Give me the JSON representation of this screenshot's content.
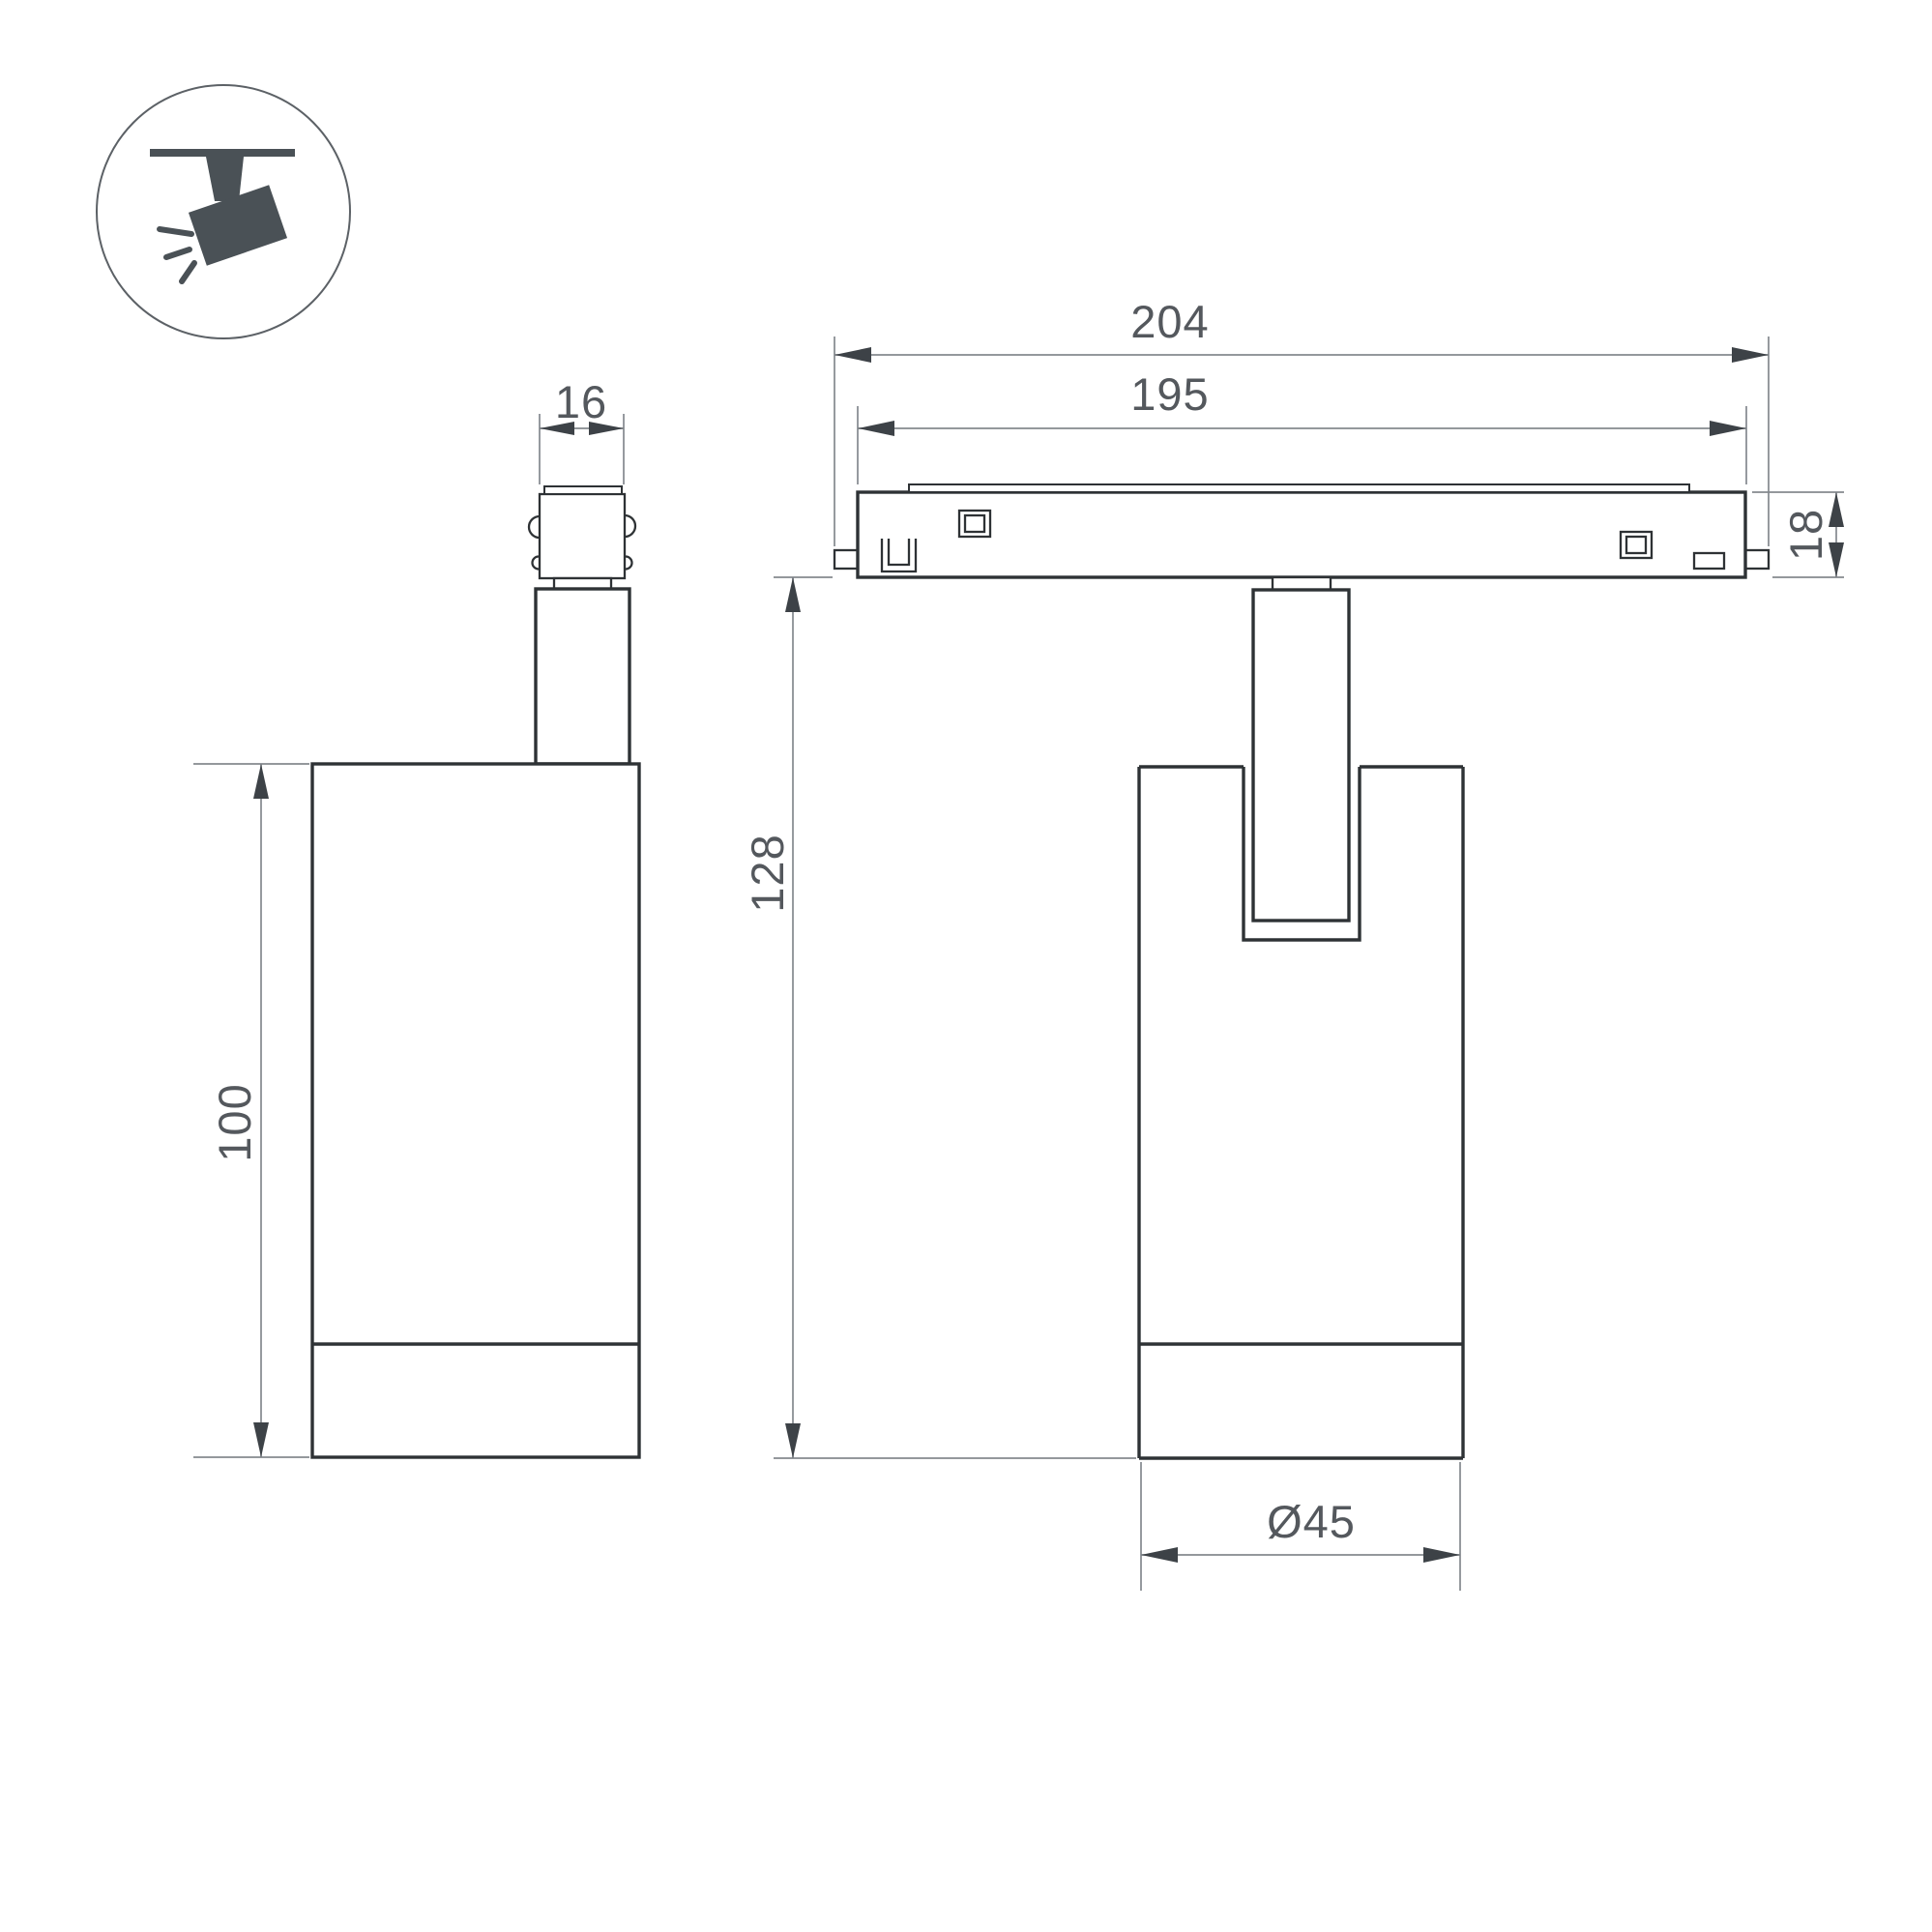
{
  "drawing": {
    "kind": "technical dimension drawing",
    "product": "magnetic track spotlight luminaire",
    "units": "mm",
    "views": {
      "badge": "ceiling track spotlight pictogram",
      "left": "side view of spotlight",
      "right": "front view with track adapter"
    },
    "colors": {
      "object_line": "#2e3235",
      "dimension_line": "#84898e",
      "arrow": "#3d4247",
      "label_text": "#54585d",
      "icon": "#4a5156",
      "background": "#ffffff"
    }
  },
  "dims": {
    "d16": {
      "label": "16",
      "mm": 16,
      "meaning": "adapter connector width"
    },
    "d204": {
      "label": "204",
      "mm": 204,
      "meaning": "track adapter overall length"
    },
    "d195": {
      "label": "195",
      "mm": 195,
      "meaning": "track adapter body length"
    },
    "d18": {
      "label": "18",
      "mm": 18,
      "meaning": "track adapter height"
    },
    "d128": {
      "label": "128",
      "mm": 128,
      "meaning": "overall height below track"
    },
    "d100": {
      "label": "100",
      "mm": 100,
      "meaning": "spotlight body height"
    },
    "d45": {
      "label": "Ø45",
      "mm": 45,
      "meaning": "spotlight body diameter"
    }
  }
}
